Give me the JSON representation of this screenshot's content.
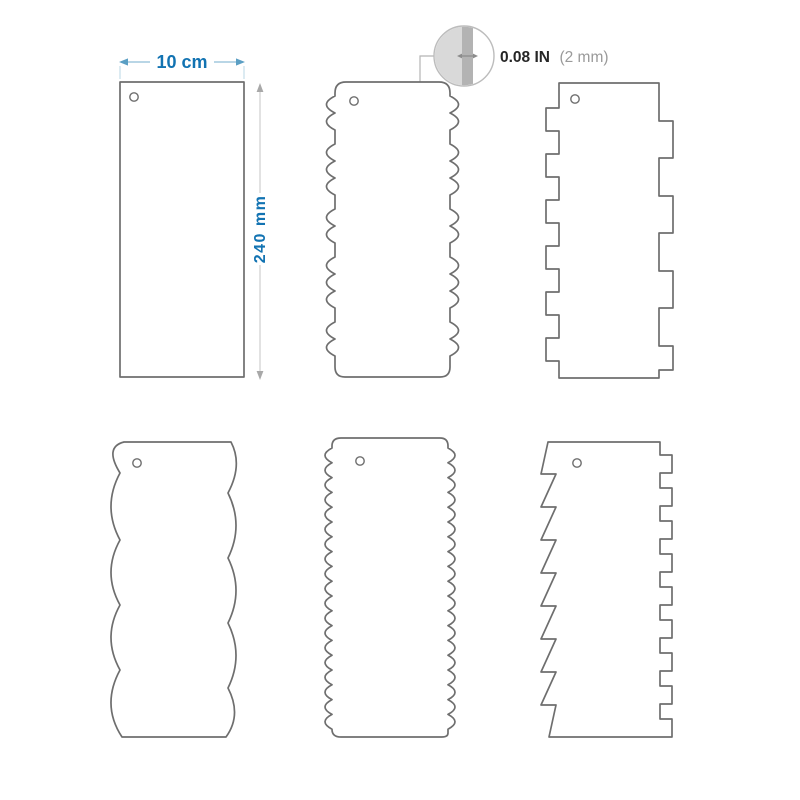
{
  "dimensions": {
    "width_label": "10 cm",
    "height_label": "240 mm"
  },
  "thickness": {
    "value": "0.08 IN",
    "metric": "(2 mm)"
  },
  "colors": {
    "dimension_blue": "#1273b2",
    "dimension_line_blue": "#8fbdd6",
    "outline_gray": "#6e6e6e",
    "callout_light_gray": "#d9d9d9",
    "callout_dark_gray": "#b3b3b3",
    "thickness_value_color": "#262626",
    "thickness_metric_color": "#9a9a9a"
  },
  "shapes": [
    {
      "id": "plain-scraper",
      "description": "Plain straight-edge scraper with hanging hole, 10 cm wide by 240 mm tall"
    },
    {
      "id": "grouped-scallop-comb",
      "description": "Comb with grouped round scallop teeth on both side edges, 2 mm thick"
    },
    {
      "id": "square-tooth-comb",
      "description": "Comb with small square teeth on left edge and wide square teeth on right edge"
    },
    {
      "id": "large-scallop-comb",
      "description": "Comb with large shallow scalloped waves on both side edges"
    },
    {
      "id": "fine-wave-comb",
      "description": "Comb with fine continuous wavy teeth on both side edges"
    },
    {
      "id": "sawtooth-comb",
      "description": "Comb with diagonal sawtooth teeth on left edge and square teeth on right edge"
    }
  ]
}
